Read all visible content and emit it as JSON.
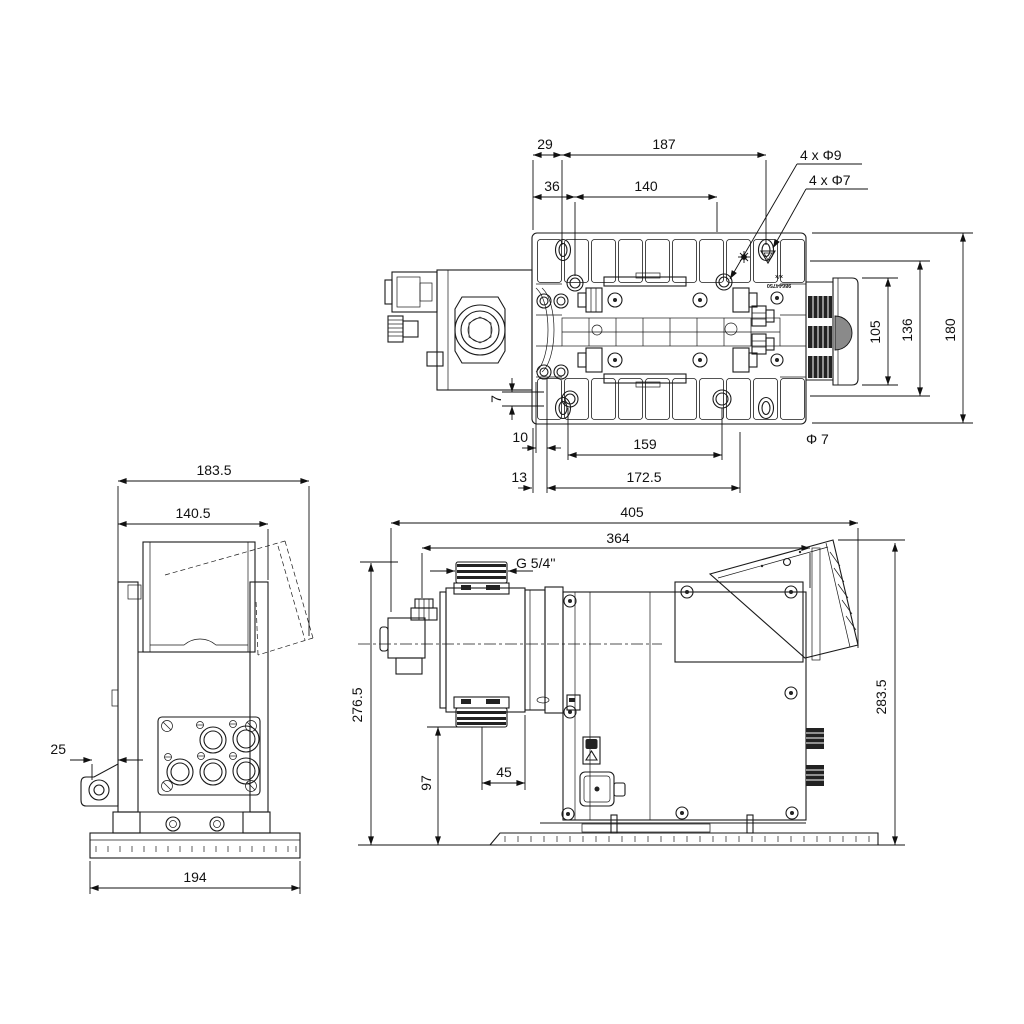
{
  "top": {
    "d29": "29",
    "d187": "187",
    "d36": "36",
    "d140": "140",
    "holes_phi9": "4 x Φ9",
    "holes_phi7": "4 x Φ7",
    "d105": "105",
    "d136": "136",
    "d180": "180",
    "d7": "7",
    "d10": "10",
    "d159": "159",
    "phi7": "Φ 7",
    "d13": "13",
    "d172_5": "172.5",
    "stamp_line1": "x/x",
    "stamp_line2": "98644750"
  },
  "left": {
    "d183_5": "183.5",
    "d140_5": "140.5",
    "d25": "25",
    "d194": "194"
  },
  "right": {
    "d405": "405",
    "d364": "364",
    "thread": "G 5/4''",
    "d276_5": "276.5",
    "d97": "97",
    "d45": "45",
    "d283_5": "283.5"
  }
}
